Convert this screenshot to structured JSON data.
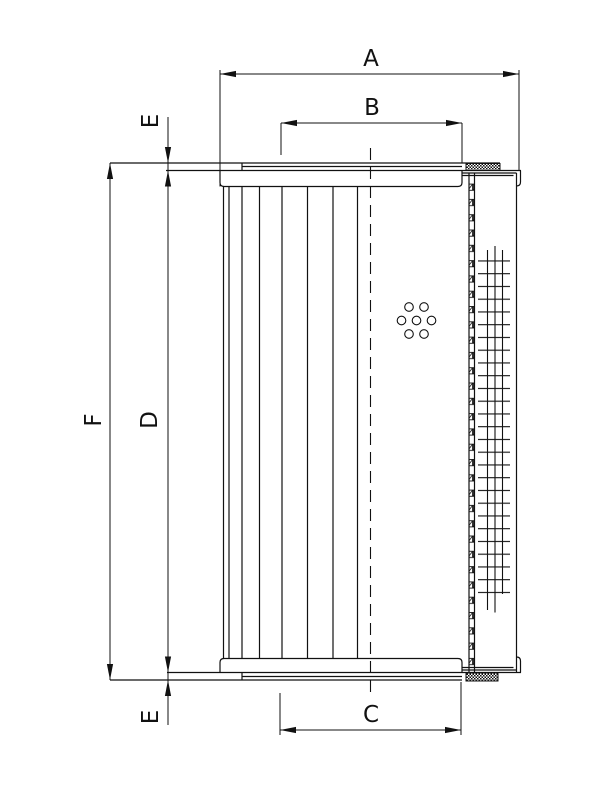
{
  "page": {
    "background": "#ffffff",
    "line_color": "#111111"
  },
  "drawing": {
    "kind": "technical-dimension-drawing",
    "labels": {
      "a": "A",
      "b": "B",
      "c": "C",
      "d": "D",
      "f": "F",
      "e_top": "E",
      "e_bottom": "E"
    }
  }
}
